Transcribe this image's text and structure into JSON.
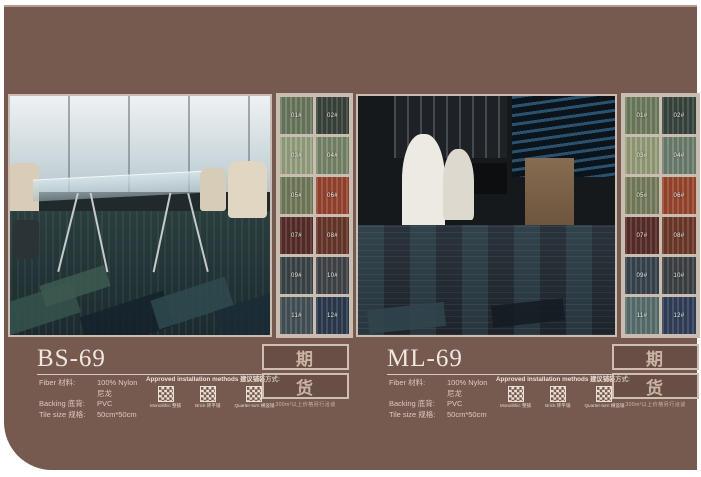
{
  "colors": {
    "page_bg": "#ffffff",
    "panel_bg": "#765a50",
    "panel_top_highlight": "#b59c92",
    "frame_border": "#c9bdb1",
    "title_color": "#efe6e0",
    "text_color": "#dcc9c0"
  },
  "products": [
    {
      "code": "BS-69",
      "photo_alt": "office meeting room with glass table and green carpet tiles",
      "specs": [
        {
          "label": "Fiber 材料:",
          "value": "100% Nylon 尼龙"
        },
        {
          "label": "Backing 底背:",
          "value": "PVC"
        },
        {
          "label": "Tile size 规格:",
          "value": "50cm*50cm"
        }
      ],
      "installation": {
        "header": "Approved installation methods 建议铺装方式:",
        "methods": [
          {
            "label": "Monolithic 整铺"
          },
          {
            "label": "Brick 砖平铺"
          },
          {
            "label": "Quarter-turn 横竖铺"
          }
        ]
      },
      "stamp": {
        "char_top": "期",
        "char_bottom": "货",
        "note": "300m²以上价格另行洽谈"
      },
      "swatches": [
        {
          "label": "01#",
          "color": "#6e7d62"
        },
        {
          "label": "02#",
          "color": "#3b463d"
        },
        {
          "label": "03#",
          "color": "#9ba684"
        },
        {
          "label": "04#",
          "color": "#7b8a6d"
        },
        {
          "label": "05#",
          "color": "#767f60"
        },
        {
          "label": "06#",
          "color": "#9b4732"
        },
        {
          "label": "07#",
          "color": "#582f2a"
        },
        {
          "label": "08#",
          "color": "#6a392c"
        },
        {
          "label": "09#",
          "color": "#3c4649"
        },
        {
          "label": "10#",
          "color": "#43474a"
        },
        {
          "label": "11#",
          "color": "#475459"
        },
        {
          "label": "12#",
          "color": "#2c3c4f"
        }
      ]
    },
    {
      "code": "ML-69",
      "photo_alt": "dark lounge bar with white chairs and blue carpet tiles",
      "specs": [
        {
          "label": "Fiber 材料:",
          "value": "100% Nylon 尼龙"
        },
        {
          "label": "Backing 底背:",
          "value": "PVC"
        },
        {
          "label": "Tile size 规格:",
          "value": "50cm*50cm"
        }
      ],
      "installation": {
        "header": "Approved installation methods 建议铺装方式:",
        "methods": [
          {
            "label": "Monolithic 整铺"
          },
          {
            "label": "Brick 砖平铺"
          },
          {
            "label": "Quarter-turn 横竖铺"
          }
        ]
      },
      "stamp": {
        "char_top": "期",
        "char_bottom": "货",
        "note": "300m²以上价格另行洽谈"
      },
      "swatches": [
        {
          "label": "01#",
          "color": "#718060"
        },
        {
          "label": "02#",
          "color": "#3a4740"
        },
        {
          "label": "03#",
          "color": "#9aa37f"
        },
        {
          "label": "04#",
          "color": "#708272"
        },
        {
          "label": "05#",
          "color": "#7a8260"
        },
        {
          "label": "06#",
          "color": "#9d4a31"
        },
        {
          "label": "07#",
          "color": "#5b2f2b"
        },
        {
          "label": "08#",
          "color": "#703c2c"
        },
        {
          "label": "09#",
          "color": "#3a4650"
        },
        {
          "label": "10#",
          "color": "#3f4447"
        },
        {
          "label": "11#",
          "color": "#5c7371"
        },
        {
          "label": "12#",
          "color": "#33425b"
        }
      ]
    }
  ]
}
